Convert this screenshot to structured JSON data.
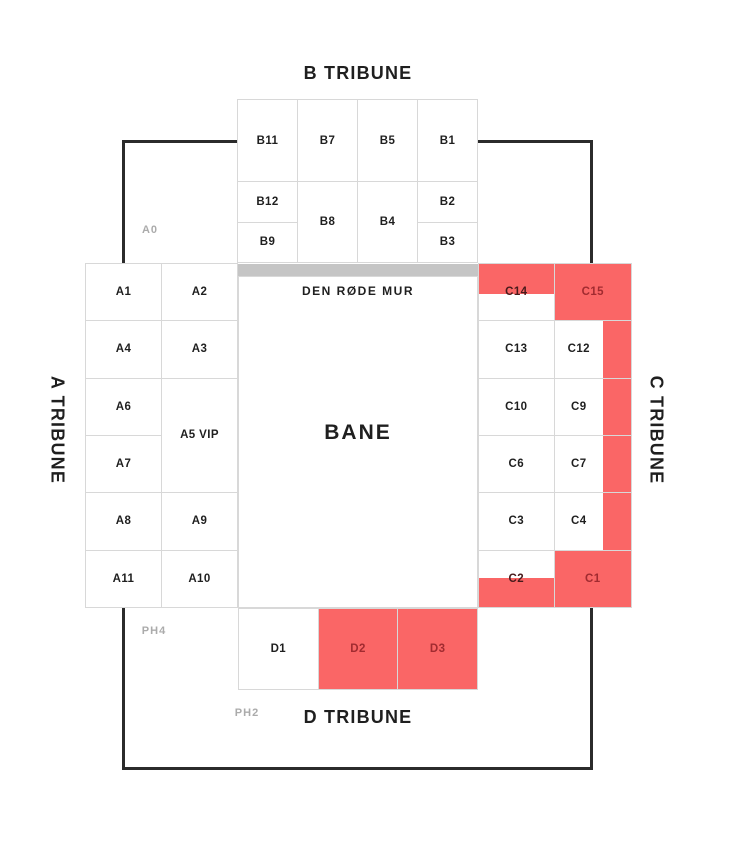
{
  "stadium_map": {
    "tribune_titles": {
      "a": "A TRIBUNE",
      "b": "B TRIBUNE",
      "c": "C TRIBUNE",
      "d": "D TRIBUNE"
    },
    "field_label": "BANE",
    "red_wall_label": "DEN RØDE MUR",
    "zone_labels": {
      "a0": "A0",
      "ph4": "PH4",
      "ph2": "PH2"
    },
    "colors": {
      "highlight_red": "#fa6666",
      "highlight_label_red": "#a12b30",
      "straddle_label_red": "#471a1b",
      "wall_gray": "#c5c5c5",
      "grid_line": "#d8d8d8",
      "outline_black": "#2b2b2b",
      "text_dark": "#1f1f1f",
      "text_gray": "#ababab"
    },
    "blocks": {
      "a": {
        "sections": [
          {
            "id": "A1",
            "label": "A1",
            "col": 1,
            "row": 1
          },
          {
            "id": "A2",
            "label": "A2",
            "col": 2,
            "row": 1
          },
          {
            "id": "A4",
            "label": "A4",
            "col": 1,
            "row": 2
          },
          {
            "id": "A3",
            "label": "A3",
            "col": 2,
            "row": 2
          },
          {
            "id": "A6",
            "label": "A6",
            "col": 1,
            "row": 3
          },
          {
            "id": "A5",
            "label": "A5 VIP",
            "col": 2,
            "row": 3,
            "rowspan": 2
          },
          {
            "id": "A7",
            "label": "A7",
            "col": 1,
            "row": 4
          },
          {
            "id": "A8",
            "label": "A8",
            "col": 1,
            "row": 5
          },
          {
            "id": "A9",
            "label": "A9",
            "col": 2,
            "row": 5
          },
          {
            "id": "A11",
            "label": "A11",
            "col": 1,
            "row": 6
          },
          {
            "id": "A10",
            "label": "A10",
            "col": 2,
            "row": 6
          }
        ]
      },
      "b": {
        "sections": [
          {
            "id": "B11",
            "label": "B11",
            "col": 1,
            "row": 1
          },
          {
            "id": "B7",
            "label": "B7",
            "col": 2,
            "row": 1
          },
          {
            "id": "B5",
            "label": "B5",
            "col": 3,
            "row": 1
          },
          {
            "id": "B1",
            "label": "B1",
            "col": 4,
            "row": 1
          },
          {
            "id": "B12",
            "label": "B12",
            "col": 1,
            "row": 2
          },
          {
            "id": "B8",
            "label": "B8",
            "col": 2,
            "row": 2,
            "rowspan": 2
          },
          {
            "id": "B4",
            "label": "B4",
            "col": 3,
            "row": 2,
            "rowspan": 2
          },
          {
            "id": "B2",
            "label": "B2",
            "col": 4,
            "row": 2
          },
          {
            "id": "B9",
            "label": "B9",
            "col": 1,
            "row": 3
          },
          {
            "id": "B3",
            "label": "B3",
            "col": 4,
            "row": 3
          }
        ]
      },
      "c": {
        "sections": [
          {
            "id": "C14",
            "label": "C14",
            "col": 1,
            "row": 1,
            "state": "red-top"
          },
          {
            "id": "C15",
            "label": "C15",
            "col": 2,
            "row": 1,
            "state": "red"
          },
          {
            "id": "C13",
            "label": "C13",
            "col": 1,
            "row": 2
          },
          {
            "id": "C12",
            "label": "C12",
            "col": 2,
            "row": 2,
            "state": "strip"
          },
          {
            "id": "C10",
            "label": "C10",
            "col": 1,
            "row": 3
          },
          {
            "id": "C9",
            "label": "C9",
            "col": 2,
            "row": 3,
            "state": "strip"
          },
          {
            "id": "C6",
            "label": "C6",
            "col": 1,
            "row": 4
          },
          {
            "id": "C7",
            "label": "C7",
            "col": 2,
            "row": 4,
            "state": "strip"
          },
          {
            "id": "C3",
            "label": "C3",
            "col": 1,
            "row": 5
          },
          {
            "id": "C4",
            "label": "C4",
            "col": 2,
            "row": 5,
            "state": "strip"
          },
          {
            "id": "C2",
            "label": "C2",
            "col": 1,
            "row": 6,
            "state": "red-bottom"
          },
          {
            "id": "C1",
            "label": "C1",
            "col": 2,
            "row": 6,
            "state": "red"
          }
        ]
      },
      "d": {
        "sections": [
          {
            "id": "D1",
            "label": "D1",
            "col": 1,
            "row": 1
          },
          {
            "id": "D2",
            "label": "D2",
            "col": 2,
            "row": 1,
            "state": "red"
          },
          {
            "id": "D3",
            "label": "D3",
            "col": 3,
            "row": 1,
            "state": "red"
          }
        ]
      }
    }
  }
}
